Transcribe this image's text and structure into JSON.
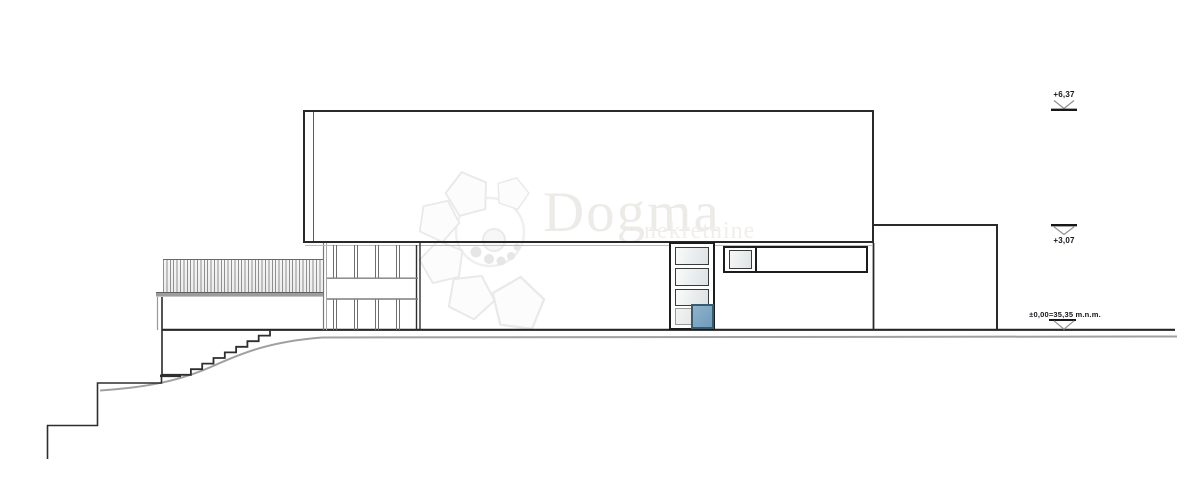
{
  "drawing": {
    "title": "house-side-elevation",
    "watermark": {
      "brand": "Dogma",
      "tagline": "nekretnine"
    },
    "level_markers": [
      {
        "id": "roof",
        "label": "+6,37"
      },
      {
        "id": "upper",
        "label": "+3,07"
      },
      {
        "id": "ground",
        "label": "±0,00=35,35 m.n.m."
      }
    ],
    "colors": {
      "line_dark": "#262626",
      "line_gray": "#9a9a9a",
      "glass_blue": "#7fa9c6",
      "glass_blue_border": "#3a5a6e",
      "glass_light": "#e3e7e9",
      "watermark_gray": "#edebe8",
      "background": "#ffffff"
    }
  }
}
